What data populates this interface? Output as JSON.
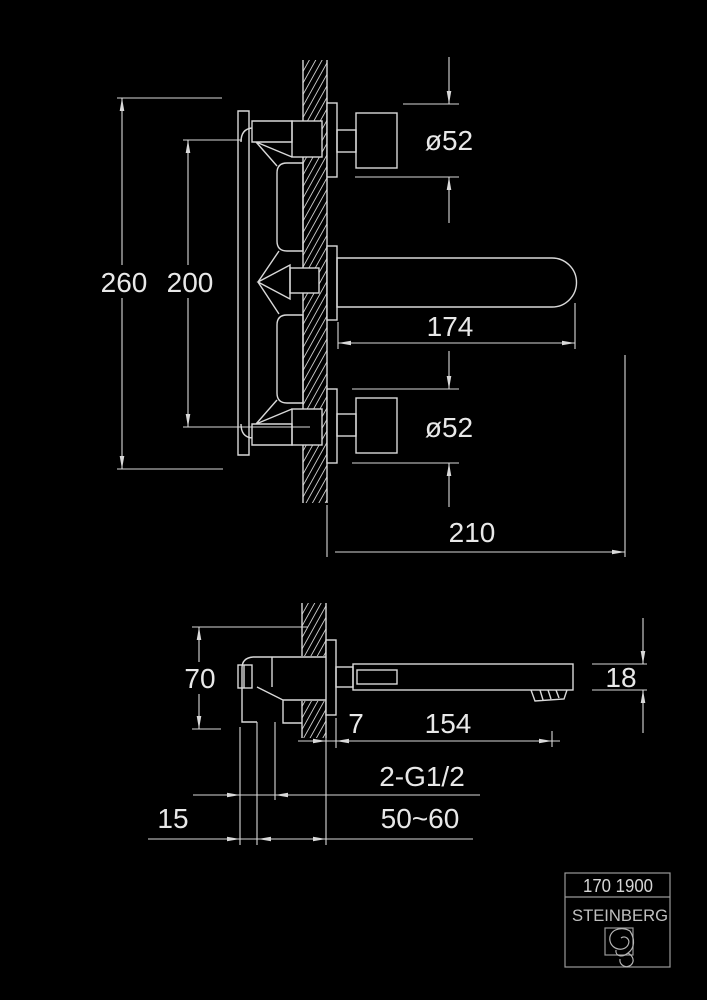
{
  "colors": {
    "background": "#000000",
    "line": "#d9d9d9",
    "text": "#e8e8e8",
    "title_border": "#9a9a9a"
  },
  "front_view": {
    "overall_height": "260",
    "handle_spacing": "200",
    "top_handle_diameter": "ø52",
    "spout_length": "174",
    "bottom_handle_diameter": "ø52",
    "projection": "210"
  },
  "side_view": {
    "body_height": "70",
    "trim_depth": "7",
    "outlet_reach": "154",
    "spout_height": "18",
    "thread_label": "2-G1/2",
    "inlet_offset": "15",
    "wall_depth_range": "50~60"
  },
  "title_block": {
    "model_number": "170 1900",
    "brand": "STEINBERG"
  }
}
